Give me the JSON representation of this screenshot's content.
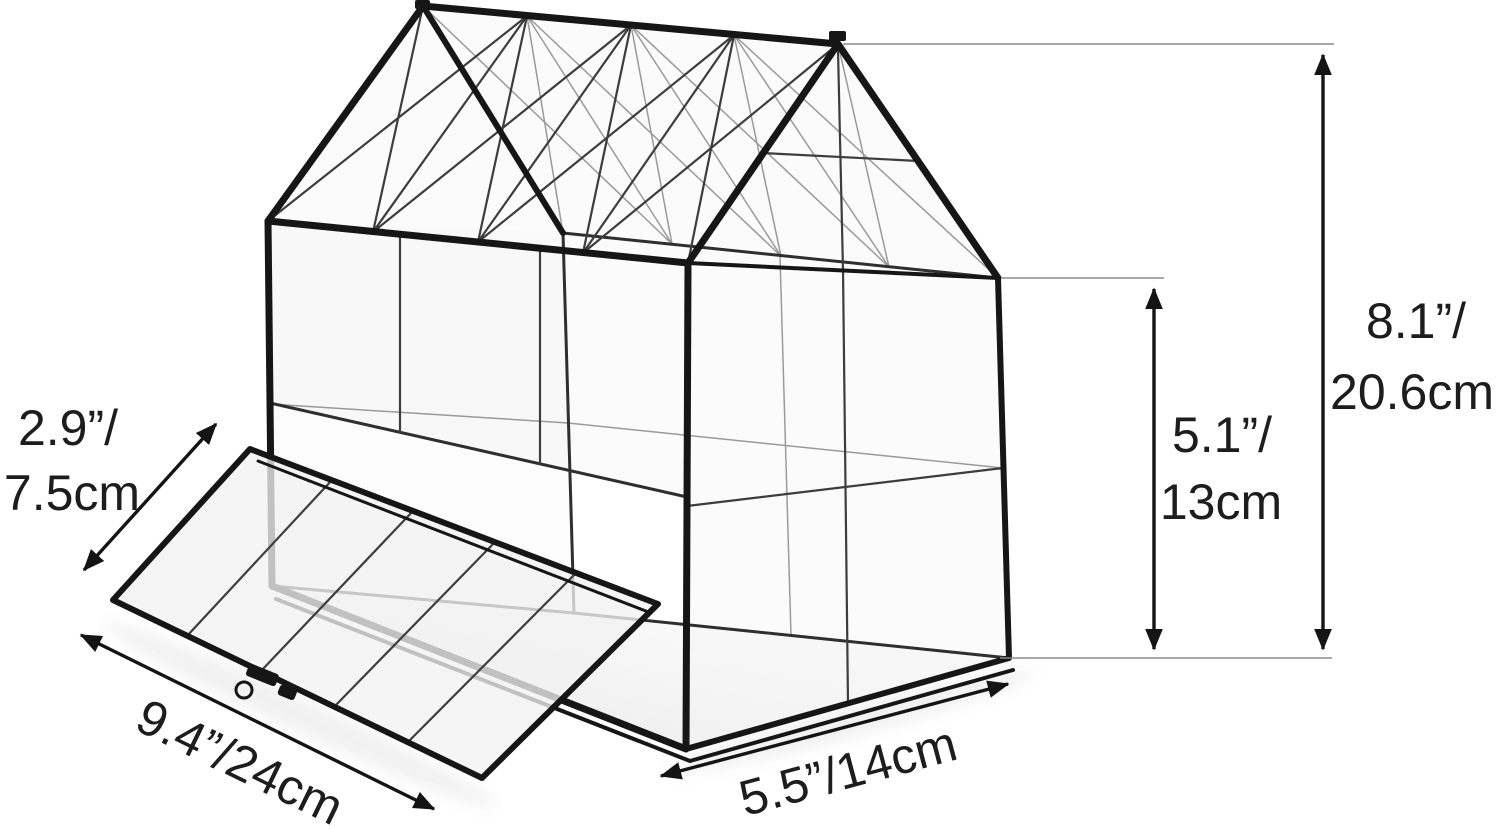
{
  "figure": {
    "subject": "House-shaped clear glass terrarium with black metal frame, lattice roof and fold-down front door, annotated with product dimensions",
    "background": "#ffffff"
  },
  "colors": {
    "frame": "#161616",
    "frame_medium": "#2f2f2f",
    "divider": "#3d3d3d",
    "faint": "#9a9a9a",
    "extension": "#8c8c8c",
    "dimension": "#141414",
    "text": "#1d1d1d",
    "glass": "#f2f2f2",
    "floor_dark": "#e9e9e9",
    "floor_light": "#fcfcfc"
  },
  "dimensions": {
    "door_height": {
      "line1": "2.9”/",
      "line2": "7.5cm"
    },
    "door_width": {
      "label": "9.4”/24cm"
    },
    "base_depth": {
      "label": "5.5”/14cm"
    },
    "wall_height": {
      "line1": "5.1”/",
      "line2": "13cm"
    },
    "total_height": {
      "line1": "8.1”/",
      "line2": "20.6cm"
    }
  }
}
